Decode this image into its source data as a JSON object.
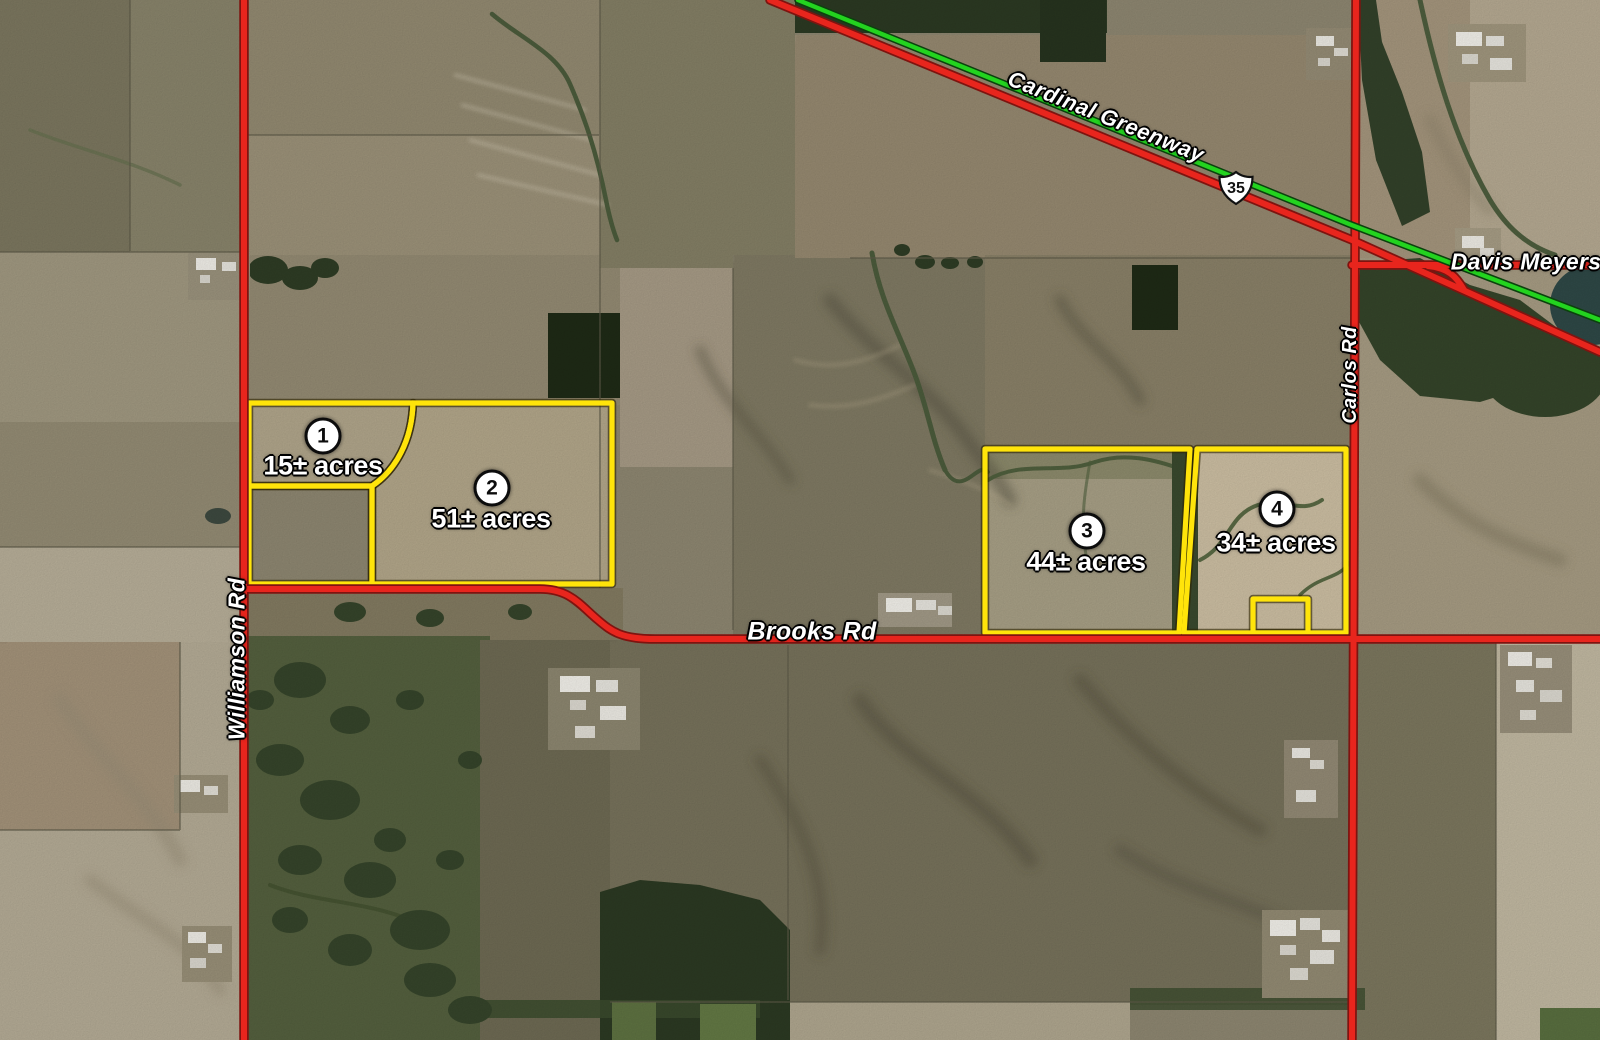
{
  "parcels": [
    {
      "number": "1",
      "acres": "15± acres"
    },
    {
      "number": "2",
      "acres": "51± acres"
    },
    {
      "number": "3",
      "acres": "44± acres"
    },
    {
      "number": "4",
      "acres": "34± acres"
    }
  ],
  "roads": {
    "williamson": "Williamson Rd",
    "brooks": "Brooks Rd",
    "carlos": "Carlos Rd",
    "davis_meyers": "Davis Meyers Rd",
    "cardinal_greenway": "Cardinal Greenway",
    "us_route_shield": "35"
  },
  "colors": {
    "road_red": "#e8251d",
    "greenway_green": "#23d31f",
    "parcel_yellow": "#ffe40a",
    "label_white": "#ffffff"
  }
}
